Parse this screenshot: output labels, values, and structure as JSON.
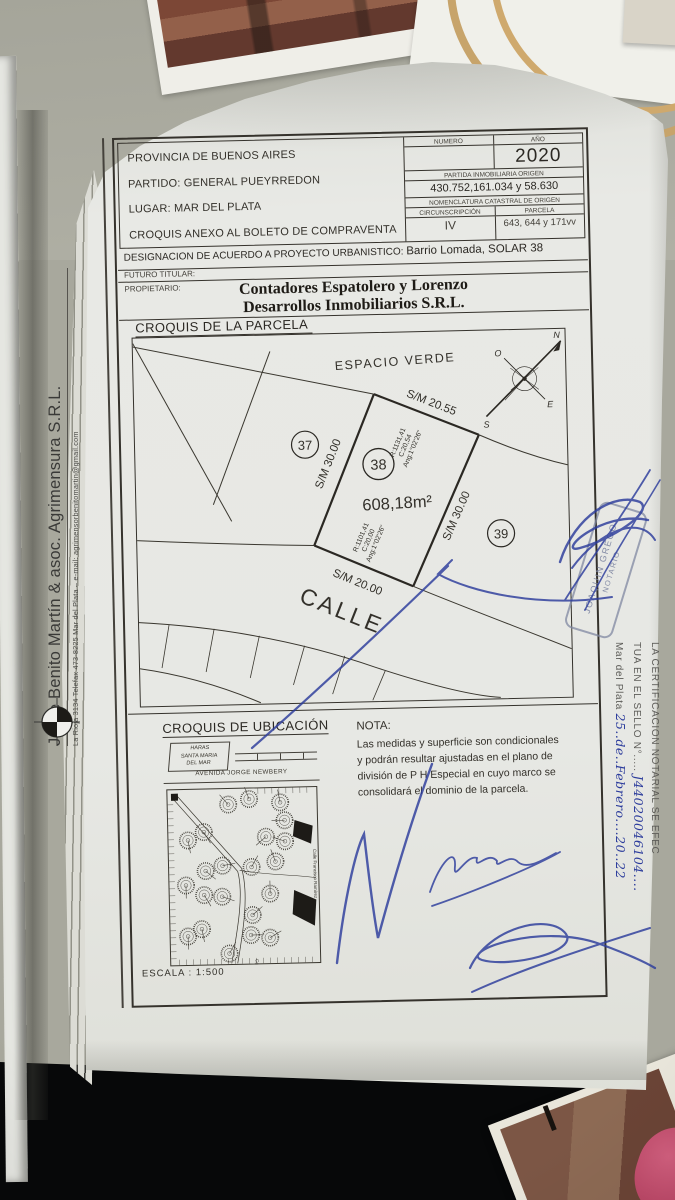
{
  "header": {
    "line1": "PROVINCIA DE BUENOS AIRES",
    "line2": "PARTIDO: GENERAL PUEYRREDON",
    "line3": "LUGAR: MAR DEL PLATA",
    "line4": "CROQUIS ANEXO AL BOLETO DE COMPRAVENTA",
    "table": {
      "numero_label": "NUMERO",
      "anio_label": "AÑO",
      "anio_value": "2020",
      "partida_label": "PARTIDA INMOBILIARIA ORIGEN",
      "partida_value": "430.752,161.034 y 58.630",
      "nomenclatura_label": "NOMENCLATURA CATASTRAL DE ORIGEN",
      "circ_label": "CIRCUNSCRIPCIÓN",
      "circ_value": "IV",
      "parcela_label": "PARCELA",
      "parcela_value": "643, 644 y 171vv"
    }
  },
  "designacion": {
    "label": "DESIGNACION DE ACUERDO A PROYECTO URBANISTICO:",
    "value": "Barrio Lomada, SOLAR 38"
  },
  "futuro_titular": {
    "label": "FUTURO TITULAR:"
  },
  "propietario": {
    "label": "PROPIETARIO:",
    "name_line1": "Contadores Espatolero y Lorenzo",
    "name_line2": "Desarrollos Inmobiliarios S.R.L."
  },
  "sketch": {
    "title": "CROQUIS DE LA PARCELA",
    "espacio_verde": "ESPACIO VERDE",
    "lot37": "37",
    "lot38": "38",
    "lot39": "39",
    "area": "608,18m²",
    "rear_measure": "S/M 20.55",
    "left_measure": "S/M 30.00",
    "right_measure": "S/M 30.00",
    "front_measure": "S/M 20.00",
    "rear_curve_r": "R:1131,41",
    "rear_curve_c": "C:20,54",
    "rear_curve_ang": "Ang:1°02'26\"",
    "front_curve_r": "R:1101,41",
    "front_curve_c": "C:20,00",
    "front_curve_ang": "Ang:1°02'26\"",
    "street": "CALLE",
    "compass_n": "N",
    "compass_s": "S",
    "compass_e": "E",
    "compass_o": "O"
  },
  "ubicacion": {
    "title": "CROQUIS DE UBICACIÓN",
    "haras": "HARAS\nSANTA MARIA\nDEL MAR",
    "avenida": "AVENIDA JORGE NEWBERY",
    "calle_right": "Calle Francisco Ramírez",
    "calle_bottom": "Calle"
  },
  "nota": {
    "label": "NOTA:",
    "text": "Las medidas y superficie son condicionales\ny podrán resultar ajustadas en el plano de\ndivisión de P H Especial en cuyo marco se\nconsolidará el dominio de la parcela."
  },
  "escala": "ESCALA : 1:500",
  "firm": {
    "name": "Jorge Benito Martín & asoc. Agrimensura S.R.L.",
    "address": "La Rioja 3134  Telefax 473-8225  Mar del Plata  –  e-mail: agrimensorbenitomartin@gmail.com"
  },
  "notary": {
    "cert_line1": "LA CERTIFICACION NOTARIAL SE EFEC",
    "cert_line2_prefix": "TUA EN EL SELLO N°.....",
    "cert_line2_value": "J44020046104....",
    "cert_line3_prefix": "Mar del Plata",
    "cert_line3_value": "25..de..Febrero....20..22",
    "stamp_line1": "JOAQUIN GREGO",
    "stamp_line2": "NOTARIO"
  },
  "colors": {
    "ink": "#33302a",
    "blue_ink": "#2c3c9c",
    "stamp_ink": "#8088a2"
  }
}
